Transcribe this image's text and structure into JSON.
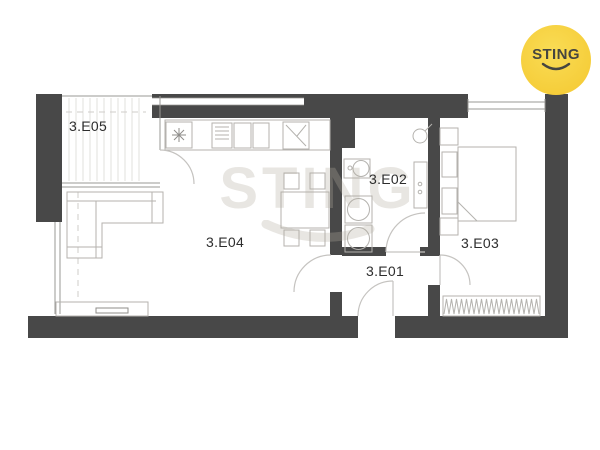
{
  "branding": {
    "logo_text": "STING",
    "watermark_text": "STING"
  },
  "floor_plan": {
    "rooms": [
      {
        "id": "3.E05",
        "type": "balcony"
      },
      {
        "id": "3.E04",
        "type": "living-room-kitchen"
      },
      {
        "id": "3.E02",
        "type": "bathroom"
      },
      {
        "id": "3.E01",
        "type": "entrance-hall"
      },
      {
        "id": "3.E03",
        "type": "bedroom"
      }
    ],
    "fixtures": [
      "hob-icon",
      "dishwasher-icon",
      "sink-icon",
      "fridge-icon",
      "dining-table",
      "chair",
      "sofa",
      "tv-cabinet",
      "tv",
      "washbasin-icon",
      "washing-machine-icon",
      "dryer-icon",
      "shower-icon",
      "bathroom-shelf",
      "bed",
      "pillow",
      "nightstand",
      "wardrobe",
      "balcony-hatch",
      "window",
      "door-arc"
    ]
  },
  "colors": {
    "background": "#ffffff",
    "wall": "#484848",
    "furniture_line": "#b4b2ae",
    "architect_line": "#9a9895",
    "door_arc": "#c5c3c0",
    "label_text": "#2d2d2d",
    "logo_yellow": "#f6ce3b",
    "logo_text": "#454540",
    "watermark": "rgba(178,172,160,0.30)",
    "balcony_stripe": "#e6e5e2"
  }
}
